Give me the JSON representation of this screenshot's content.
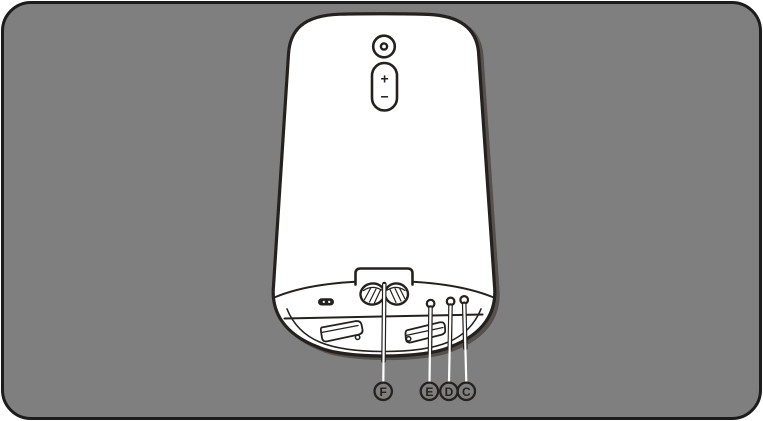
{
  "page": {
    "background": "#ffffff"
  },
  "panel": {
    "fill": "#7f7f7f",
    "border_color": "#1c1c1c"
  },
  "artwork": {
    "line_color": "#25211f",
    "body_fill": "#ffffff",
    "shadow_color": "#554f4e",
    "leader_line_color": "#ffffff",
    "subject": "device-rear-bottom-view"
  },
  "device": {
    "volume_up": "+",
    "volume_down": "−"
  },
  "callouts": [
    {
      "label": "F",
      "target": "power-cord-wrap"
    },
    {
      "label": "E",
      "target": "small-round-port-1"
    },
    {
      "label": "D",
      "target": "small-round-port-2"
    },
    {
      "label": "C",
      "target": "small-round-port-3"
    }
  ]
}
